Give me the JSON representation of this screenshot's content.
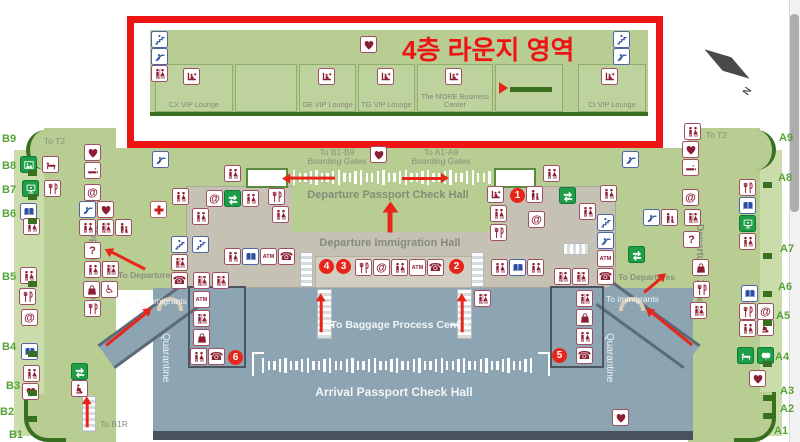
{
  "highlight": {
    "title": "4층 라운지 영역"
  },
  "lounges": [
    "CX VIP Lounge",
    "GE VIP Lounge",
    "TG VIP Lounge",
    "The MORE Business Center",
    "CI VIP Lounge"
  ],
  "labels": {
    "to_b_gates_line1": "To B1-B9",
    "to_a_gates_line1": "To A1-A9",
    "boarding_gates": "Boarding Gates",
    "departure_passport_hall": "Departure Passport Check Hall",
    "departure_immigration_hall": "Departure Immigration Hall",
    "baggage_center": "To Baggage Process Center",
    "arrival_passport_hall": "Arrival Passport Check Hall",
    "quarantine": "Quarantine",
    "zone_b": "Departures Zone B",
    "zone_a": "Departures Zone A",
    "to_t2": "To T2",
    "to_departures": "To Departures",
    "to_immigrants": "To immigrants",
    "to_b1r": "To B1R",
    "compass_north": "N"
  },
  "gates": {
    "left": [
      "B9",
      "B8",
      "B7",
      "B6",
      "B5",
      "B4",
      "B3",
      "B2",
      "B1"
    ],
    "right": [
      "A9",
      "A8",
      "A7",
      "A6",
      "A5",
      "A4",
      "A3",
      "A2",
      "A1"
    ]
  },
  "markers": [
    "1",
    "2",
    "3",
    "4",
    "5",
    "6"
  ],
  "icons": {
    "atm": "ATM",
    "internet": "@",
    "information": "?",
    "wheelchair": "♿",
    "telephone": "☎"
  },
  "colors": {
    "map_green": "#b7cd92",
    "hall_gray": "#c6c2b3",
    "arrival_blue": "#8da4b2",
    "highlight_red": "#ee1414",
    "icon_maroon": "#8c1f33",
    "icon_blue": "#2b4ea0",
    "sign_green": "#1f9d49",
    "gate_green": "#55a336"
  }
}
